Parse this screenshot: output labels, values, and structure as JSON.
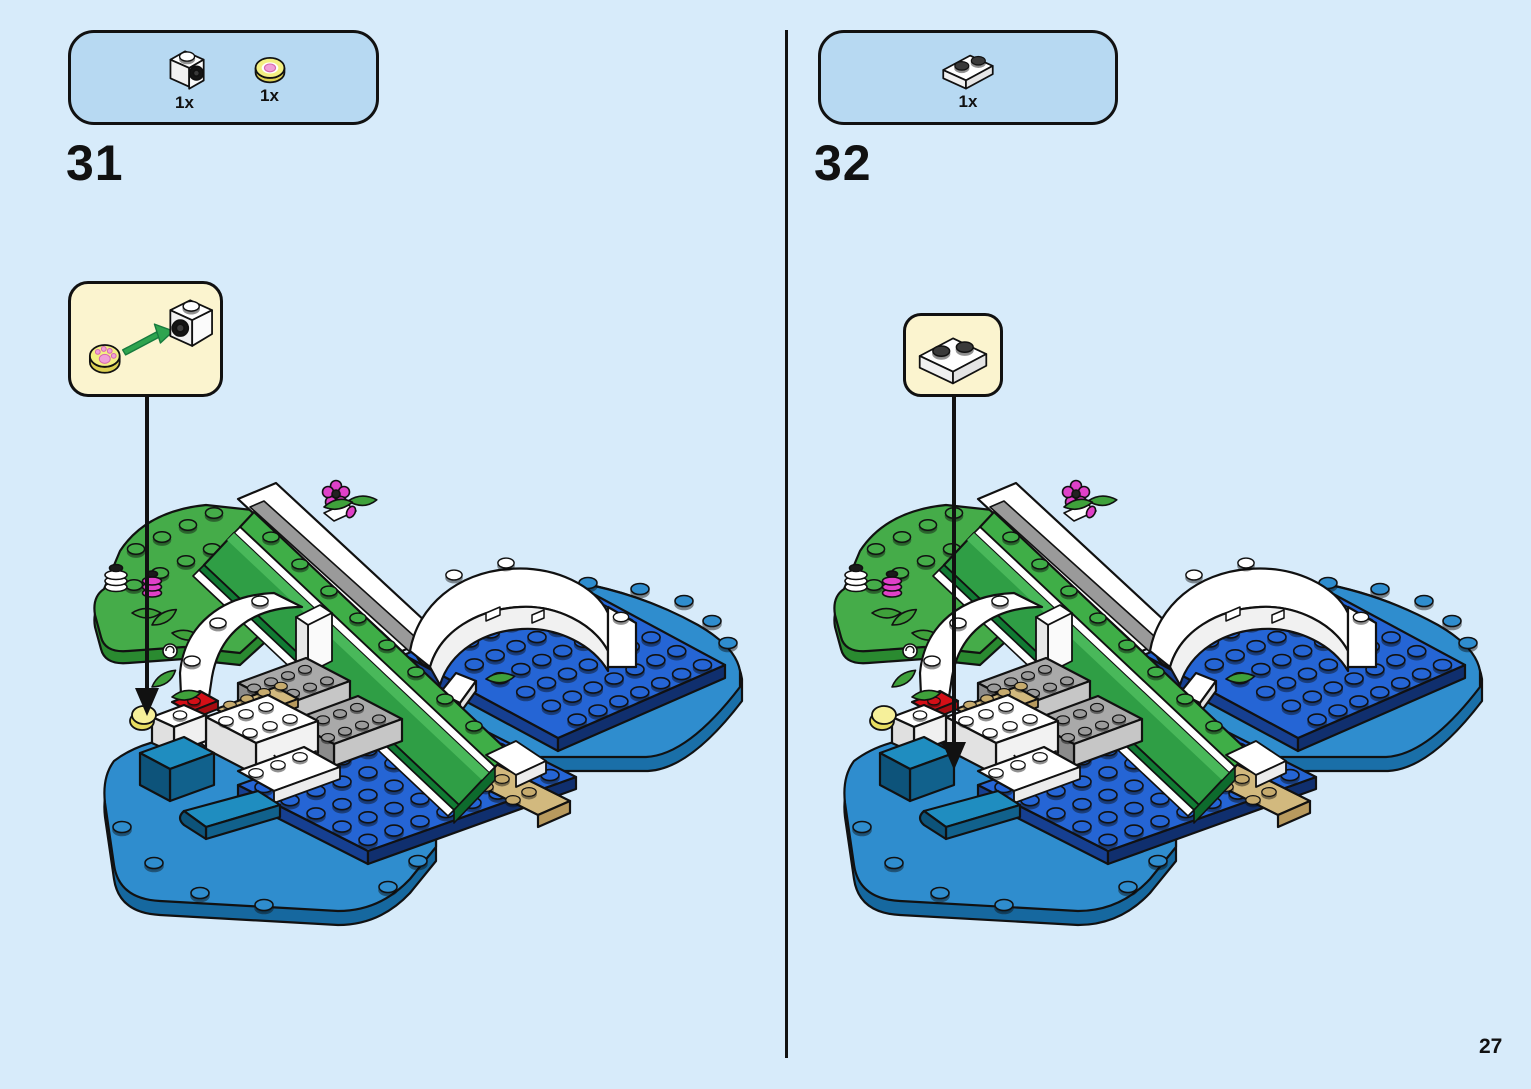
{
  "page": {
    "number": "27"
  },
  "steps": [
    {
      "number": "31",
      "parts_box": {
        "parts": [
          {
            "icon": "white-plate-1x1-holder-icon",
            "qty": "1x"
          },
          {
            "icon": "yellow-round-tile-paw-icon",
            "qty": "1x"
          }
        ]
      },
      "callout": {
        "icons": [
          "yellow-round-tile-paw-icon",
          "green-insert-arrow-icon",
          "white-plate-1x1-holder-icon"
        ]
      }
    },
    {
      "number": "32",
      "parts_box": {
        "parts": [
          {
            "icon": "white-plate-1x2-icon",
            "qty": "1x"
          }
        ]
      },
      "callout": {
        "icons": [
          "white-plate-1x2-icon"
        ]
      }
    }
  ],
  "colors": {
    "background": "#d7ebfa",
    "parts_panel_blue": "#b7d9f2",
    "callout_cream": "#fbf4cf",
    "outline": "#111111",
    "plate_blue": "#2565d5",
    "base_azure": "#2f8dce",
    "baseplate_green": "#45ac49",
    "slide_green": "#2f9e45",
    "brick_gray": "#a9a9a9",
    "tan": "#d2b97e",
    "red": "#d40f17",
    "yellow": "#f3ef82",
    "flower_magenta": "#e040c8",
    "teal": "#1f8dc0",
    "white": "#ffffff",
    "insert_arrow_green": "#2ea44f"
  }
}
